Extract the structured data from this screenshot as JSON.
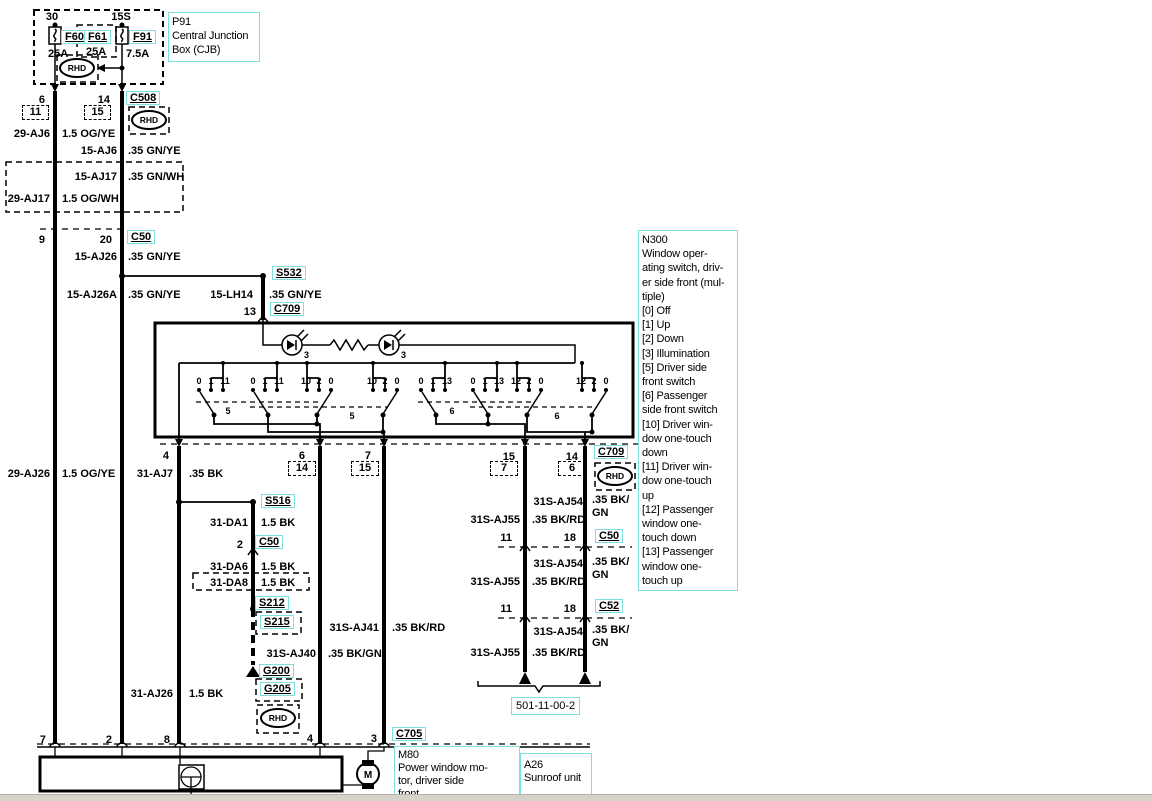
{
  "cjb": {
    "title": [
      "P91",
      "Central Junction",
      "Box (CJB)"
    ],
    "terminal_left": "30",
    "terminal_right": "15S",
    "fuses": [
      {
        "id": "F60",
        "rating": "25A"
      },
      {
        "id": "F61",
        "rating": "25A"
      },
      {
        "id": "F91",
        "rating": "7.5A"
      }
    ]
  },
  "markers": {
    "rhd": "RHD"
  },
  "connectors": {
    "c508": "C508",
    "c50": "C50",
    "c709": "C709",
    "c52": "C52",
    "c705": "C705"
  },
  "splices": {
    "s532": "S532",
    "s516": "S516",
    "s212": "S212",
    "s215": "S215"
  },
  "grounds": {
    "g200": "G200",
    "g205": "G205"
  },
  "reference": {
    "page": "501-11-00-2"
  },
  "pins": {
    "p2": "2",
    "p3": "3",
    "p4": "4",
    "p6": "6",
    "p7": "7",
    "p8": "8",
    "p9": "9",
    "p11": "11",
    "p13": "13",
    "p14": "14",
    "p15": "15",
    "p18": "18",
    "p20": "20"
  },
  "wires": {
    "aj6_feed": {
      "id": "29-AJ6",
      "spec": "1.5 OG/YE"
    },
    "aj6_sw": {
      "id": "15-AJ6",
      "spec": ".35 GN/YE"
    },
    "aj17_sw": {
      "id": "15-AJ17",
      "spec": ".35 GN/WH"
    },
    "aj17_feed": {
      "id": "29-AJ17",
      "spec": "1.5 OG/WH"
    },
    "aj26_sw": {
      "id": "15-AJ26",
      "spec": ".35 GN/YE"
    },
    "aj26a": {
      "id": "15-AJ26A",
      "spec": ".35 GN/YE"
    },
    "lh14": {
      "id": "15-LH14",
      "spec": ".35 GN/YE"
    },
    "aj26_feed": {
      "id": "29-AJ26",
      "spec": "1.5 OG/YE"
    },
    "aj7": {
      "id": "31-AJ7",
      "spec": ".35 BK"
    },
    "da1": {
      "id": "31-DA1",
      "spec": "1.5 BK"
    },
    "da6": {
      "id": "31-DA6",
      "spec": "1.5 BK"
    },
    "da8": {
      "id": "31-DA8",
      "spec": "1.5 BK"
    },
    "aj26_gnd": {
      "id": "31-AJ26",
      "spec": "1.5 BK"
    },
    "saj40": {
      "id": "31S-AJ40",
      "spec": ".35 BK/GN"
    },
    "saj41": {
      "id": "31S-AJ41",
      "spec": ".35 BK/RD"
    },
    "saj54": {
      "id": "31S-AJ54",
      "spec_line1": ".35 BK/",
      "spec_line2": "GN"
    },
    "saj55": {
      "id": "31S-AJ55",
      "spec": ".35 BK/RD"
    }
  },
  "switch_internals": {
    "led_value": "3",
    "contact_groups": [
      [
        "0",
        "1",
        "11"
      ],
      [
        "0",
        "1",
        "11"
      ],
      [
        "10",
        "2",
        "0"
      ],
      [
        "10",
        "2",
        "0"
      ],
      [
        "0",
        "1",
        "13"
      ],
      [
        "0",
        "1",
        "13"
      ],
      [
        "12",
        "2",
        "0"
      ],
      [
        "12",
        "2",
        "0"
      ]
    ],
    "link_labels": [
      "5",
      "5",
      "6",
      "6"
    ]
  },
  "n300": {
    "lines": [
      "N300",
      "Window oper-",
      "ating switch, driv-",
      "er side front (mul-",
      "tiple)",
      "[0] Off",
      "[1] Up",
      "[2] Down",
      "[3] Illumination",
      "[5] Driver side",
      "front switch",
      "[6] Passenger",
      "side front switch",
      "[10] Driver win-",
      "dow one-touch",
      "down",
      "[11] Driver win-",
      "dow one-touch",
      "up",
      "[12] Passenger",
      "window one-",
      "touch down",
      "[13] Passenger",
      "window one-",
      "touch up"
    ]
  },
  "m80": {
    "lines": [
      "M80",
      "Power window mo-",
      "tor, driver side",
      "front"
    ]
  },
  "a26": {
    "lines": [
      "A26",
      "Sunroof unit"
    ]
  },
  "motor_symbol": "M"
}
